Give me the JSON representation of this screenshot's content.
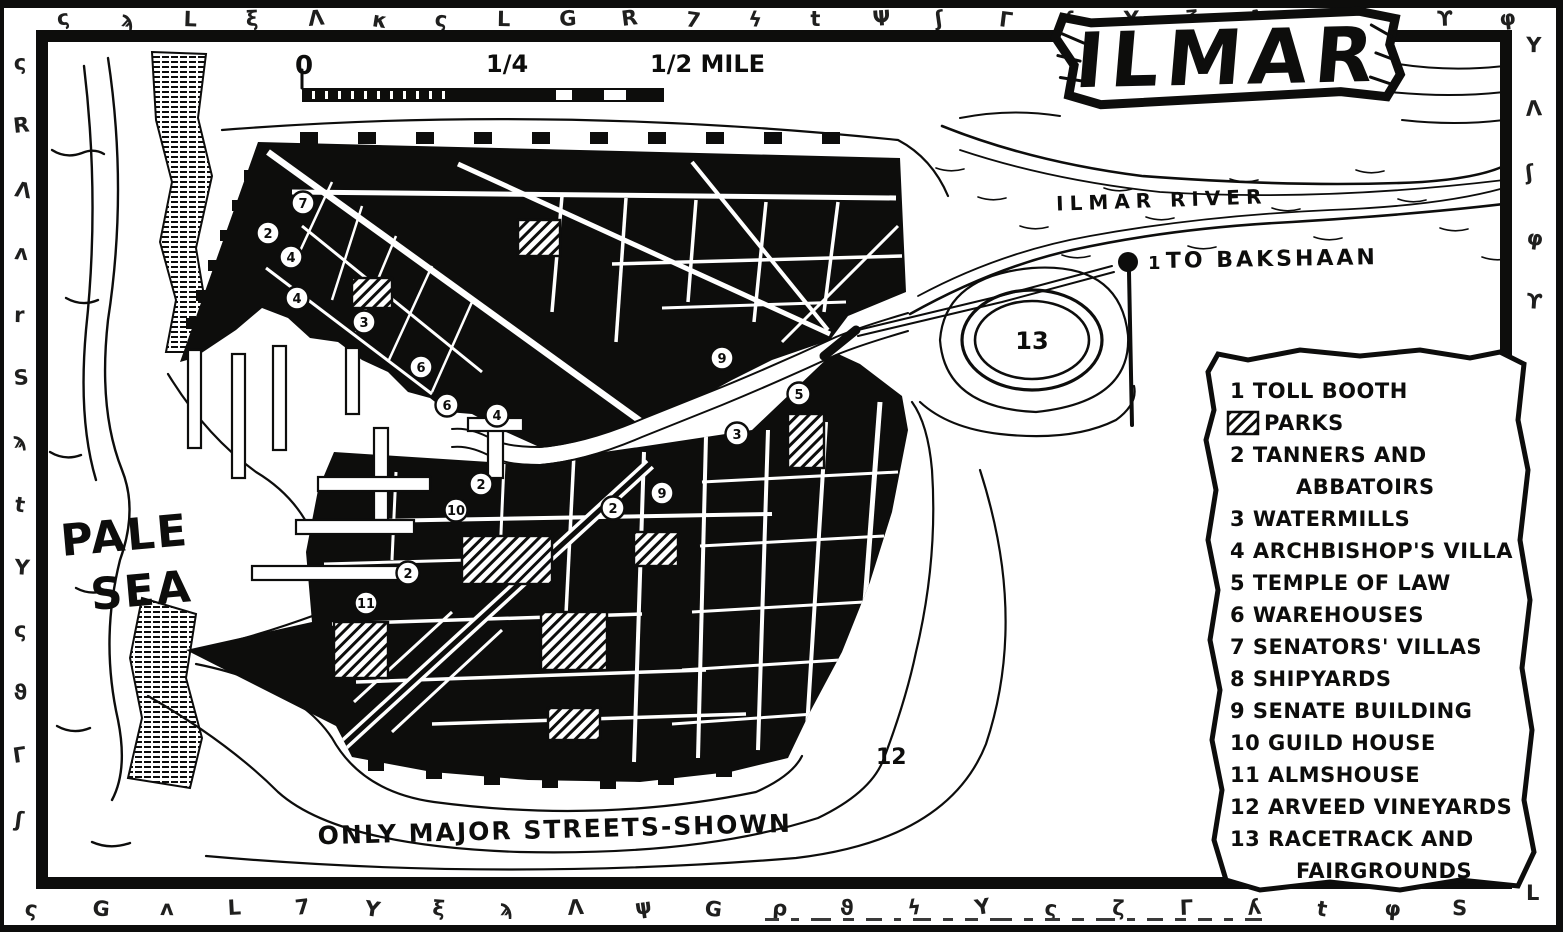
{
  "title": "ILMAR",
  "colors": {
    "ink": "#0d0d0c",
    "paper": "#ffffff"
  },
  "scale_bar": {
    "start": "0",
    "quarter": "1/4",
    "half": "1/2 MILE"
  },
  "labels": {
    "sea_line1": "PALE",
    "sea_line2": "SEA",
    "river": "ILMAR RIVER",
    "road": "TO BAKSHAAN",
    "footnote": "ONLY MAJOR STREETS-SHOWN",
    "tollbooth_number": "1",
    "vineyards_number": "12",
    "racetrack_number": "13"
  },
  "legend": {
    "items": [
      {
        "t": "1 TOLL BOOTH"
      },
      {
        "t": "PARKS",
        "swatch": true
      },
      {
        "t": "2 TANNERS AND"
      },
      {
        "t": "ABBATOIRS",
        "indent": true
      },
      {
        "t": "3 WATERMILLS"
      },
      {
        "t": "4 ARCHBISHOP'S VILLA"
      },
      {
        "t": "5 TEMPLE OF LAW"
      },
      {
        "t": "6 WAREHOUSES"
      },
      {
        "t": "7 SENATORS' VILLAS"
      },
      {
        "t": "8 SHIPYARDS"
      },
      {
        "t": "9 SENATE BUILDING"
      },
      {
        "t": "10 GUILD HOUSE"
      },
      {
        "t": "11 ALMSHOUSE"
      },
      {
        "t": "12 ARVEED VINEYARDS"
      },
      {
        "t": "13 RACETRACK AND"
      },
      {
        "t": "FAIRGROUNDS",
        "indent": true
      }
    ]
  },
  "map": {
    "markers": [
      {
        "x": 303,
        "y": 203,
        "n": "7"
      },
      {
        "x": 268,
        "y": 233,
        "n": "2"
      },
      {
        "x": 291,
        "y": 257,
        "n": "4"
      },
      {
        "x": 297,
        "y": 298,
        "n": "4"
      },
      {
        "x": 364,
        "y": 322,
        "n": "3"
      },
      {
        "x": 421,
        "y": 367,
        "n": "6"
      },
      {
        "x": 447,
        "y": 405,
        "n": "6"
      },
      {
        "x": 497,
        "y": 415,
        "n": "4"
      },
      {
        "x": 722,
        "y": 358,
        "n": "9"
      },
      {
        "x": 799,
        "y": 394,
        "n": "5"
      },
      {
        "x": 737,
        "y": 434,
        "n": "3"
      },
      {
        "x": 481,
        "y": 484,
        "n": "2"
      },
      {
        "x": 456,
        "y": 510,
        "n": "10"
      },
      {
        "x": 613,
        "y": 508,
        "n": "2"
      },
      {
        "x": 662,
        "y": 493,
        "n": "9"
      },
      {
        "x": 408,
        "y": 573,
        "n": "2"
      },
      {
        "x": 366,
        "y": 603,
        "n": "11"
      }
    ],
    "parks": [
      {
        "x": 518,
        "y": 220,
        "w": 42,
        "h": 36
      },
      {
        "x": 352,
        "y": 278,
        "w": 40,
        "h": 30
      },
      {
        "x": 788,
        "y": 414,
        "w": 36,
        "h": 54
      },
      {
        "x": 634,
        "y": 532,
        "w": 44,
        "h": 34
      },
      {
        "x": 462,
        "y": 536,
        "w": 90,
        "h": 48
      },
      {
        "x": 334,
        "y": 622,
        "w": 54,
        "h": 56
      },
      {
        "x": 541,
        "y": 612,
        "w": 66,
        "h": 58
      },
      {
        "x": 548,
        "y": 708,
        "w": 52,
        "h": 32
      }
    ]
  },
  "border_runes": {
    "top": [
      "ς",
      "ϡ",
      "L",
      "ξ",
      "Λ",
      "κ",
      "ς",
      "L",
      "G",
      "R",
      "7",
      "ϟ",
      "t",
      "Ψ",
      "ʃ",
      "Γ",
      "ʎ",
      "Y",
      "ζ",
      "Λ",
      "ι",
      "Ϟ",
      "ϒ",
      "φ"
    ],
    "left": [
      "ς",
      "R",
      "Λ",
      "ʌ",
      "r",
      "S",
      "ϡ",
      "t",
      "Y",
      "ς",
      "ϑ",
      "Γ",
      "ʃ"
    ],
    "right": [
      "Y",
      "Λ",
      "ʃ",
      "φ",
      "ϒ",
      "L"
    ],
    "bottom": [
      "ς",
      "G",
      "ʌ",
      "L",
      "7",
      "Y",
      "ξ",
      "ϡ",
      "Λ",
      "ψ",
      "G",
      "ρ",
      "ϑ",
      "ϟ",
      "Y",
      "ς",
      "ζ",
      "Γ",
      "ʎ",
      "t",
      "φ",
      "S"
    ]
  }
}
